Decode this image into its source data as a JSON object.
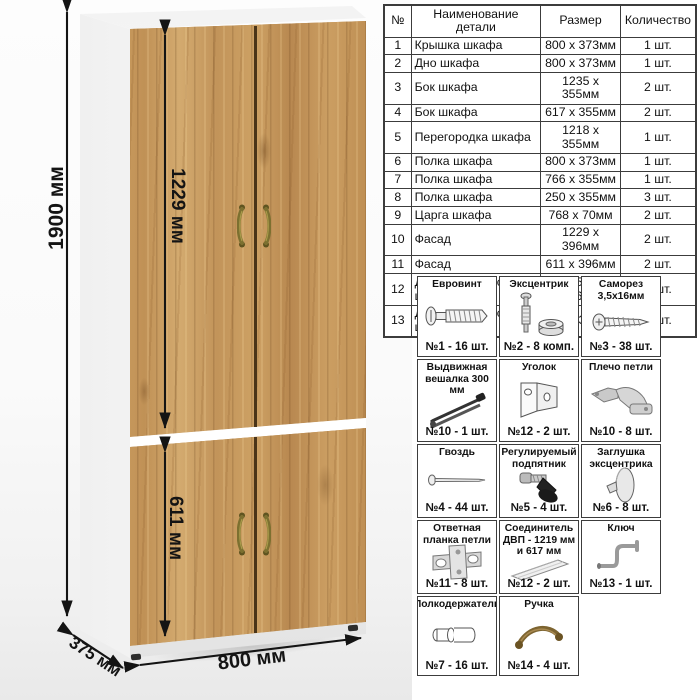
{
  "dimensions": {
    "height": "1900 мм",
    "upper_door_height": "1229 мм",
    "lower_door_height": "611 мм",
    "width": "800 мм",
    "depth": "375 мм"
  },
  "parts_table": {
    "headers": [
      "№",
      "Наименование детали",
      "Размер",
      "Количество"
    ],
    "rows": [
      {
        "num": "1",
        "name": "Крышка шкафа",
        "size": "800 x 373мм",
        "qty": "1 шт."
      },
      {
        "num": "2",
        "name": "Дно шкафа",
        "size": "800 x 373мм",
        "qty": "1 шт."
      },
      {
        "num": "3",
        "name": "Бок шкафа",
        "size": "1235 x 355мм",
        "qty": "2 шт."
      },
      {
        "num": "4",
        "name": "Бок шкафа",
        "size": "617 x 355мм",
        "qty": "2 шт."
      },
      {
        "num": "5",
        "name": "Перегородка шкафа",
        "size": "1218 x 355мм",
        "qty": "1 шт."
      },
      {
        "num": "6",
        "name": "Полка шкафа",
        "size": "800 x 373мм",
        "qty": "1 шт."
      },
      {
        "num": "7",
        "name": "Полка шкафа",
        "size": "766 x 355мм",
        "qty": "1 шт."
      },
      {
        "num": "8",
        "name": "Полка шкафа",
        "size": "250 x 355мм",
        "qty": "3 шт."
      },
      {
        "num": "9",
        "name": "Царга шкафа",
        "size": "768 x 70мм",
        "qty": "2 шт."
      },
      {
        "num": "10",
        "name": "Фасад",
        "size": "1229 x 396мм",
        "qty": "2 шт."
      },
      {
        "num": "11",
        "name": "Фасад",
        "size": "611 x 396мм",
        "qty": "2 шт."
      },
      {
        "num": "12",
        "name": "ДВП – задняя стенка шкафа",
        "size": "1257 x 396мм",
        "qty": "2 шт."
      },
      {
        "num": "13",
        "name": "ДВП – задняя стенка шкафа",
        "size": "639 x 396мм",
        "qty": "2 шт."
      }
    ]
  },
  "hardware": {
    "items": [
      {
        "name": "Евровинт",
        "count": "№1 - 16 шт.",
        "icon": "euro-screw-icon"
      },
      {
        "name": "Эксцентрик",
        "count": "№2 - 8 комп.",
        "icon": "eccentric-cam-icon"
      },
      {
        "name": "Саморез 3,5х16мм",
        "count": "№3 - 38 шт.",
        "icon": "self-tapping-screw-icon"
      },
      {
        "name": "Выдвижная вешалка 300 мм",
        "count": "№10 - 1 шт.",
        "icon": "pullout-hanger-icon"
      },
      {
        "name": "Уголок",
        "count": "№12 - 2 шт.",
        "icon": "corner-bracket-icon"
      },
      {
        "name": "Плечо петли",
        "count": "№10 - 8 шт.",
        "icon": "hinge-arm-icon"
      },
      {
        "name": "Гвоздь",
        "count": "№4 - 44 шт.",
        "icon": "nail-icon"
      },
      {
        "name": "Регулируемый подпятник",
        "count": "№5 - 4 шт.",
        "icon": "adjustable-foot-icon"
      },
      {
        "name": "Заглушка эксцентрика",
        "count": "№6 - 8 шт.",
        "icon": "cam-cover-icon"
      },
      {
        "name": "Ответная планка петли",
        "count": "№11 - 8 шт.",
        "icon": "hinge-plate-icon"
      },
      {
        "name": "Соединитель ДВП - 1219 мм и 617 мм",
        "count": "№12 - 2 шт.",
        "icon": "hdf-connector-icon"
      },
      {
        "name": "Ключ",
        "count": "№13 - 1 шт.",
        "icon": "key-icon"
      },
      {
        "name": "Полкодержатель",
        "count": "№7 - 16 шт.",
        "icon": "shelf-pin-icon"
      },
      {
        "name": "Ручка",
        "count": "№14 - 4 шт.",
        "icon": "handle-icon"
      }
    ]
  },
  "colors": {
    "wood": "#c49458",
    "handle_bronze": "#7c7030",
    "line": "#141414",
    "table_border": "#3c3c3c"
  }
}
